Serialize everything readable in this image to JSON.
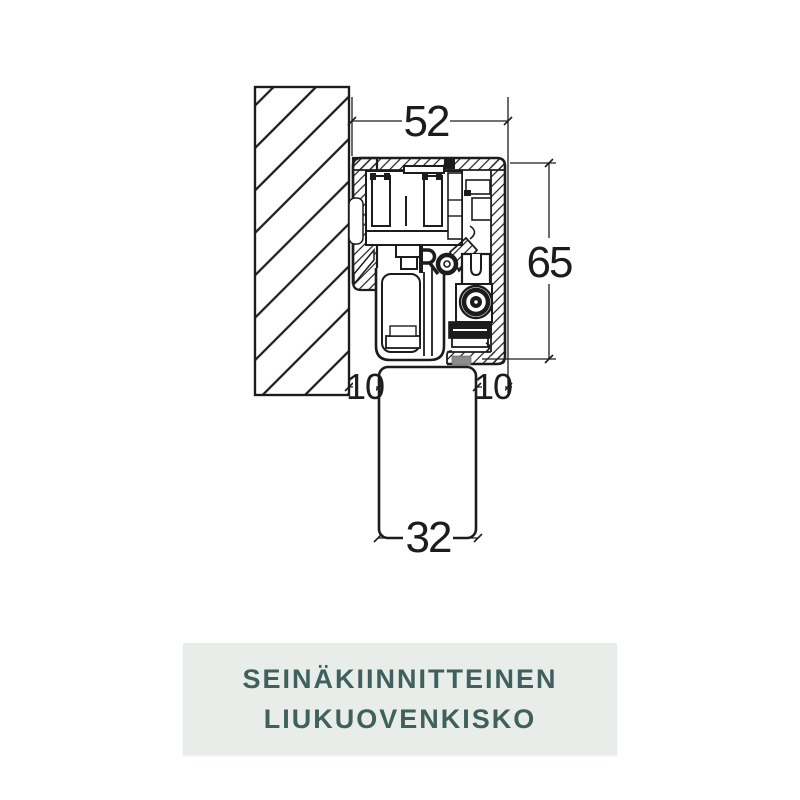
{
  "drawing": {
    "dimensions": {
      "track_width": "52",
      "track_height": "65",
      "wall_clearance": "10",
      "door_offset": "10",
      "door_thickness": "32"
    }
  },
  "caption": {
    "line1": "SEINÄKIINNITTEINEN",
    "line2": "LIUKUOVENKISKO"
  },
  "colors": {
    "line": "#1c1c1c",
    "banner_bg": "#e8ede9",
    "banner_text": "#40605d",
    "seal_gray": "#8c8c8c"
  }
}
